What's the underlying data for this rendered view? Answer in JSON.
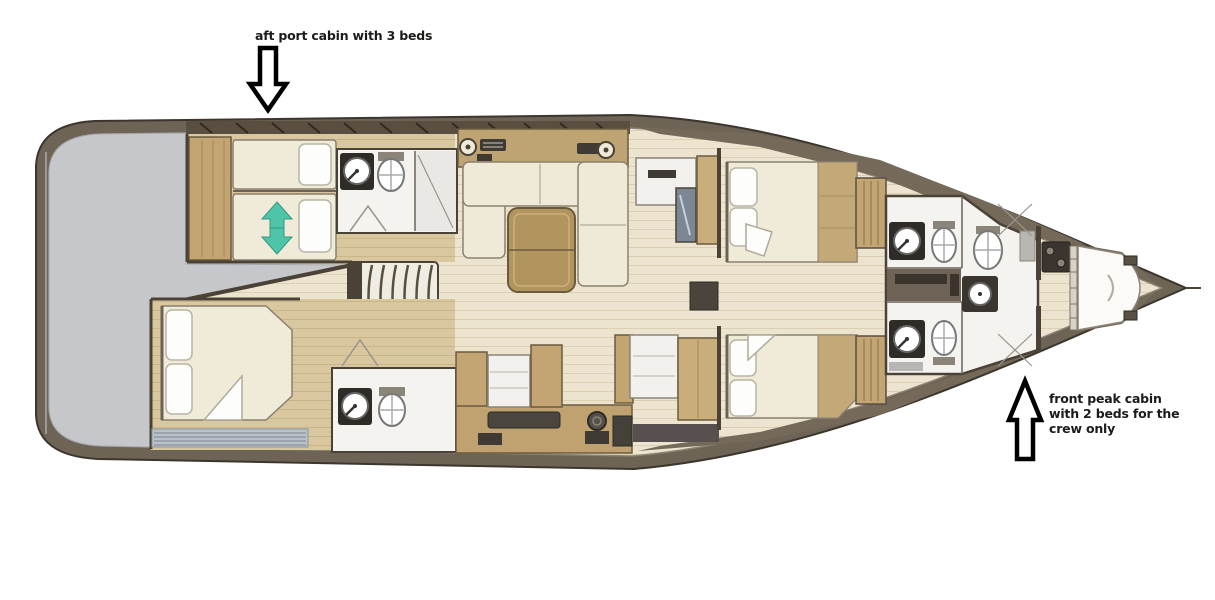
{
  "annotations": {
    "aft_port_cabin": {
      "text": "aft port cabin with 3 beds"
    },
    "front_peak_cabin": {
      "line1": "front peak cabin",
      "line2": "with 2 beds for the",
      "line3": "crew only"
    }
  },
  "diagram": {
    "type": "yacht-interior-deck-plan",
    "rooms": [
      "aft deck",
      "aft port cabin",
      "port bathroom",
      "salon",
      "curved staircase",
      "aft starboard cabin",
      "starboard bathroom",
      "galley",
      "corridor",
      "vip cabin",
      "guest cabin",
      "forward bathrooms",
      "front peak cabin"
    ]
  },
  "colors": {
    "background": "#ffffff",
    "hull_taupe": "#6e6455",
    "hull_outline": "#3c362e",
    "deck_gray": "#c6c7cb",
    "floor_cream": "#ece4ce",
    "cabin_tan": "#d8c79f",
    "furniture_tan": "#c2a572",
    "table_tan": "#b2945f",
    "wall_dark": "#4a4236",
    "bed_cream": "#f0ead8",
    "pillow_white": "#fdfdfc",
    "bathroom_white": "#f4f3f0",
    "fixture_dark": "#2f2b26",
    "louver_gray": "#b9c2c9",
    "teal_arrow": "#4fc4a9",
    "annotation_text": "#1b1b19",
    "arrow_outline": "#000000"
  }
}
